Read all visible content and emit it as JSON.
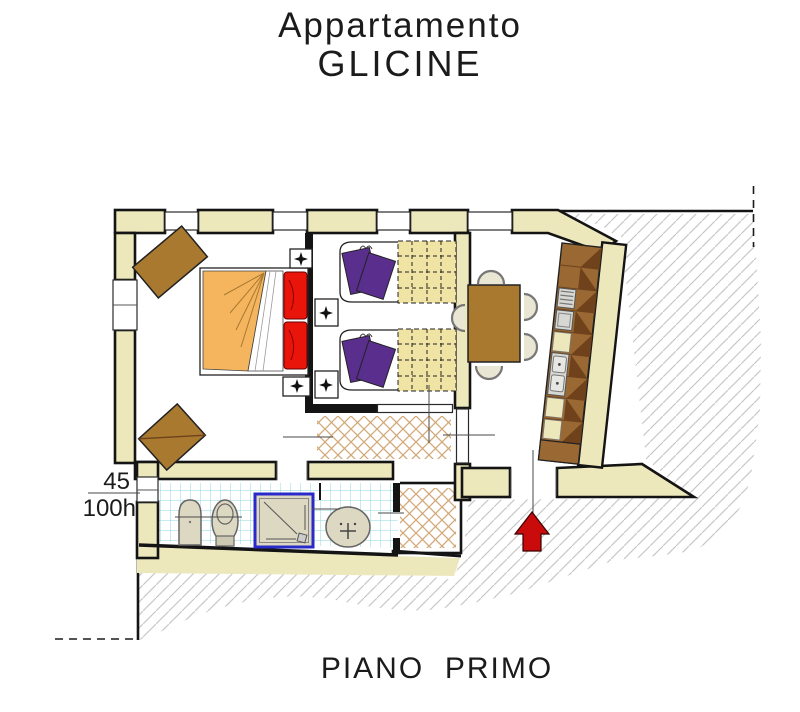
{
  "header": {
    "title_line1": "Appartamento",
    "title_line2": "GLICINE"
  },
  "footer": {
    "floor_label": "PIANO  PRIMO"
  },
  "annotations": {
    "window_width_label": "45",
    "window_height_label": "100h"
  },
  "icons": {
    "entrance_arrow": "up-arrow",
    "lamp_sparkle": "four-point-star"
  },
  "colors": {
    "wall-fill": "#EDE8BC",
    "wall-stroke": "#141414",
    "hatch": "#C8C8C8",
    "lattice": "#D2A878",
    "tile": "#8FD9E0",
    "bed-orange": "#F5B55F",
    "bed-red": "#E9150B",
    "pillow-purple": "#5A2E8C",
    "blanket-yellow": "#F0E4A4",
    "wood-brown": "#A8792F",
    "counter-brown": "#9A6933",
    "counter-dark": "#6F421C",
    "appliance-gray": "#D7D7D3",
    "fixture-beige": "#DDD8C2",
    "chair-beige": "#EAE6D4",
    "shower-blue": "#2A2ACB",
    "arrow-red": "#C90B0B",
    "text": "#1B1B1B"
  }
}
